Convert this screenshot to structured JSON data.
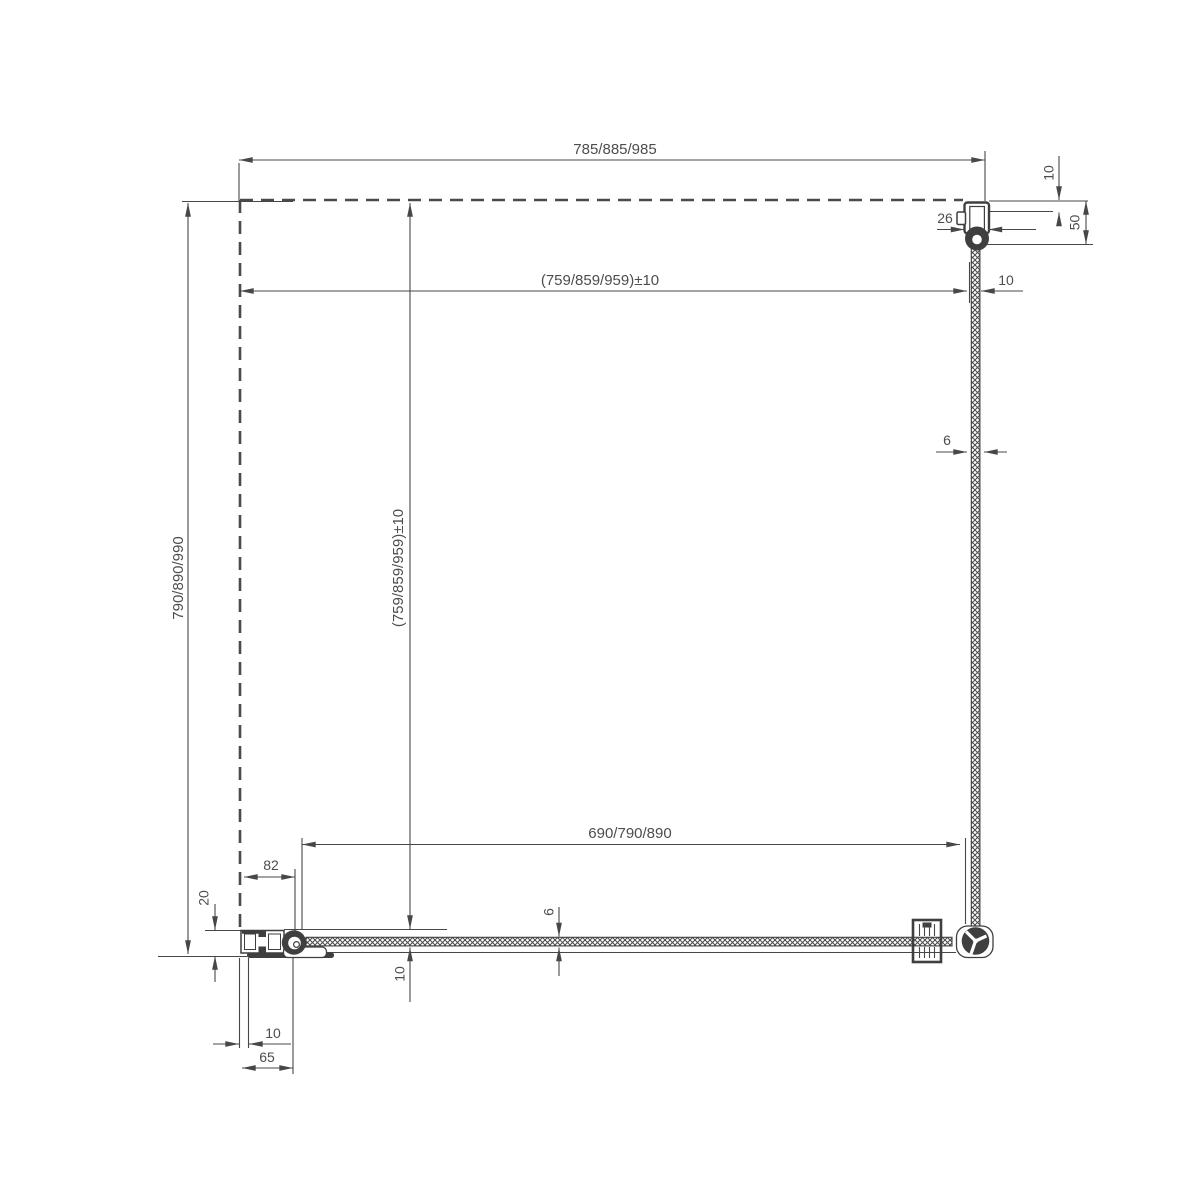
{
  "drawing": {
    "type": "technical plan view of corner shower enclosure with fixed glass panels",
    "colors": {
      "line": "#474747",
      "text": "#4d4d4d",
      "background": "#ffffff",
      "fill_dark": "#3f3f3f"
    }
  },
  "dimensions": {
    "overall_width": "785/885/985",
    "inner_width": "(759/859/959)±10",
    "inner_width_adjustment": "10",
    "wall_gap_top": "10",
    "wall_profile_width": "26",
    "wall_profile_depth": "50",
    "side_glass_thickness": "6",
    "overall_depth": "790/890/990",
    "inner_depth": "(759/859/959)±10",
    "front_glass_width": "690/790/890",
    "hinge_offset": "82",
    "bottom_profile_depth": "20",
    "front_glass_thickness": "6",
    "front_glass_gap": "10",
    "bottom_profile_gap": "10",
    "bottom_profile_length": "65"
  }
}
